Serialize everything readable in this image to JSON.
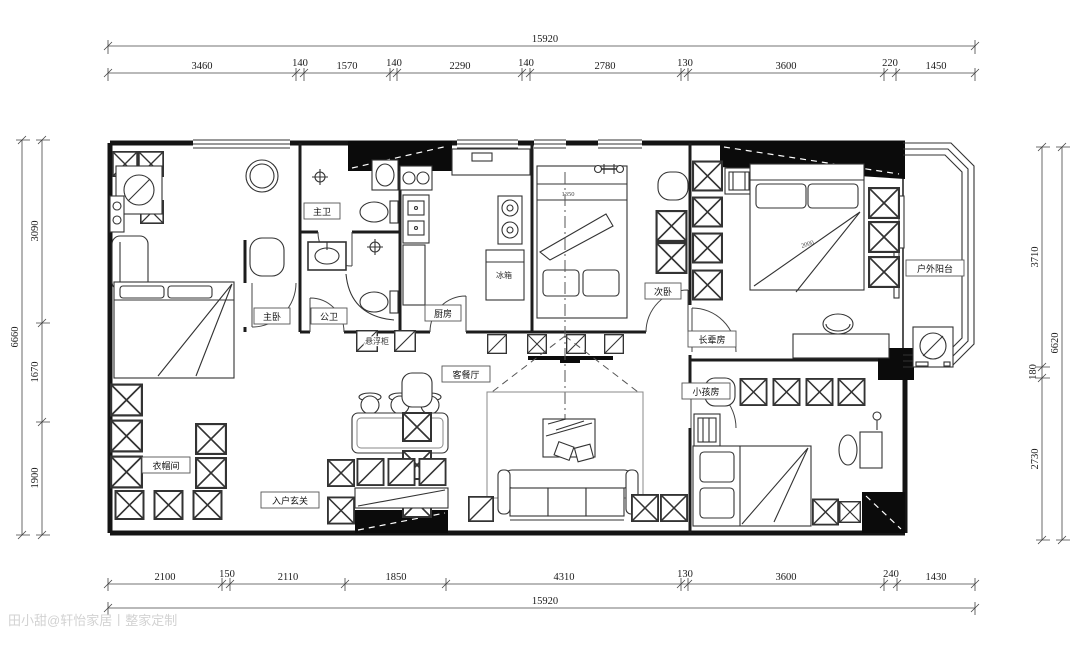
{
  "dimensions": {
    "top": {
      "total": "15920",
      "segments": [
        "3460",
        "140",
        "1570",
        "140",
        "2290",
        "140",
        "2780",
        "130",
        "3600",
        "220",
        "1450"
      ]
    },
    "bottom": {
      "total": "15920",
      "segments": [
        "2100",
        "150",
        "2110",
        "1850",
        "4310",
        "130",
        "3600",
        "240",
        "1430"
      ]
    },
    "left": {
      "total": "6660",
      "segments": [
        "3090",
        "1670",
        "1900"
      ]
    },
    "right": {
      "total": "6620",
      "segments": [
        "3710",
        "180",
        "2730"
      ]
    }
  },
  "rooms": {
    "master_bath": "主卫",
    "master_bedroom": "主卧",
    "public_bath": "公卫",
    "kitchen": "厨房",
    "fridge": "冰箱",
    "second_bedroom": "次卧",
    "elder_room": "长辈房",
    "kids_room": "小孩房",
    "outdoor_balcony": "户外阳台",
    "cloakroom": "衣帽间",
    "entry_foyer": "入户玄关",
    "living_dining": "客餐厅",
    "floating_cabinet": "悬浮柜",
    "washing_machine": "洗衣机"
  },
  "annotations": {
    "secondary_bed_width": "1350",
    "elder_bed_width": "2000"
  },
  "watermark": "田小甜@轩怡家居丨整家定制",
  "line_color": "#141414",
  "paper_color": "#ffffff"
}
